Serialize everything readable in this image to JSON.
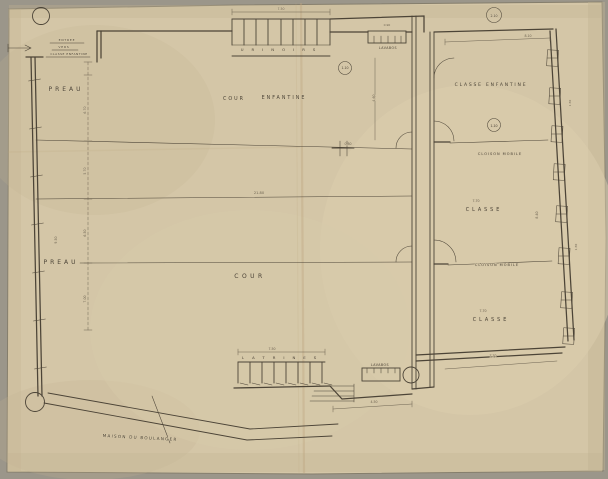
{
  "colors": {
    "margin": "#9b968a",
    "paper": "#d4c6a7",
    "paper_dark": "#c2b291",
    "edge": "#857e6c",
    "crease": "#bfa57f",
    "ink": "#4c4437",
    "ink_light": "#6e6452"
  },
  "plan": {
    "labels": [
      {
        "id": "room-label-preau-upper",
        "text": "PREAU",
        "x": 66,
        "y": 91,
        "size": 6,
        "ls": 3
      },
      {
        "id": "room-label-preau-lower",
        "text": "PREAU",
        "x": 61,
        "y": 264,
        "size": 6,
        "ls": 3
      },
      {
        "id": "room-label-cour-word",
        "text": "COUR",
        "x": 234,
        "y": 100,
        "size": 4.8,
        "ls": 2
      },
      {
        "id": "room-label-enfantine-word",
        "text": "ENFANTINE",
        "x": 284,
        "y": 99,
        "size": 4.8,
        "ls": 2
      },
      {
        "id": "room-label-cour",
        "text": "COUR",
        "x": 250,
        "y": 278,
        "size": 6,
        "ls": 3.5
      },
      {
        "id": "room-label-classe-enfantine",
        "text": "CLASSE ENFANTINE",
        "x": 491,
        "y": 86,
        "size": 4.5,
        "ls": 1.8
      },
      {
        "id": "label-cloison-mobile-upper",
        "text": "CLOISON MOBILE",
        "x": 500,
        "y": 155,
        "size": 3.5,
        "ls": 1
      },
      {
        "id": "room-label-classe-middle",
        "text": "CLASSE",
        "x": 484,
        "y": 211,
        "size": 4.8,
        "ls": 3
      },
      {
        "id": "label-cloison-mobile-lower",
        "text": "CLOISON MOBILE",
        "x": 497,
        "y": 266,
        "size": 3.5,
        "ls": 1
      },
      {
        "id": "room-label-classe-lower",
        "text": "CLASSE",
        "x": 491,
        "y": 321,
        "size": 4.8,
        "ls": 3
      },
      {
        "id": "label-maison-du-boulanger",
        "text": "MAISON DU BOULANGER",
        "x": 140,
        "y": 439,
        "size": 4.2,
        "ls": 1.2,
        "rot": 3
      },
      {
        "id": "label-lavabos-upper",
        "text": "LAVABOS",
        "x": 388,
        "y": 49,
        "size": 3.2,
        "ls": 0.5
      },
      {
        "id": "label-lavabos-lower",
        "text": "LAVABOS",
        "x": 380,
        "y": 366,
        "size": 3.2,
        "ls": 0.5
      },
      {
        "id": "label-urinoirs",
        "text": "URINOIRS",
        "x": 282,
        "y": 51,
        "size": 3.8,
        "ls": 8
      },
      {
        "id": "label-latrines",
        "text": "LATRINES",
        "x": 283,
        "y": 359,
        "size": 3.8,
        "ls": 8
      },
      {
        "id": "note-entree",
        "text": "ENTREE",
        "x": 67,
        "y": 41,
        "size": 3,
        "ls": 0.8
      },
      {
        "id": "note-vers",
        "text": "VERS",
        "x": 64,
        "y": 48,
        "size": 3,
        "ls": 0.8
      },
      {
        "id": "note-classe-enfantine",
        "text": "CLASSE ENFANTINE",
        "x": 69,
        "y": 55,
        "size": 3,
        "ls": 0.5
      },
      {
        "id": "detail-bubble-top-right",
        "text": "2.10",
        "x": 494,
        "y": 17,
        "size": 3.2
      },
      {
        "id": "detail-bubble-stalls",
        "text": "1.10",
        "x": 345,
        "y": 69,
        "size": 3.2
      },
      {
        "id": "detail-bubble-right",
        "text": "1.10",
        "x": 494,
        "y": 127,
        "size": 3.2
      },
      {
        "id": "dim-total-width",
        "text": "21.80",
        "x": 259,
        "y": 194,
        "size": 3.6,
        "cls": "dim"
      },
      {
        "id": "dim-opening",
        "text": "0.80",
        "x": 348,
        "y": 145,
        "size": 3.2,
        "cls": "dim"
      },
      {
        "id": "dim-urinoirs",
        "text": "7.50",
        "x": 281,
        "y": 10,
        "size": 3.2,
        "cls": "dim"
      },
      {
        "id": "dim-latrines",
        "text": "7.50",
        "x": 272,
        "y": 350,
        "size": 3.2,
        "cls": "dim"
      },
      {
        "id": "dim-top-right",
        "text": "8.10",
        "x": 528,
        "y": 37,
        "size": 3.2,
        "cls": "dim"
      },
      {
        "id": "dim-classe-middle",
        "text": "7.70",
        "x": 476,
        "y": 202,
        "size": 3.2,
        "cls": "dim"
      },
      {
        "id": "dim-classe-lower",
        "text": "7.70",
        "x": 483,
        "y": 312,
        "size": 3.2,
        "cls": "dim"
      },
      {
        "id": "dim-bottom-right",
        "text": "7.70",
        "x": 493,
        "y": 357,
        "size": 3.2,
        "cls": "dim"
      },
      {
        "id": "dim-bottom-court",
        "text": "4.50",
        "x": 374,
        "y": 403,
        "size": 3.2,
        "cls": "dim"
      },
      {
        "id": "dim-lavabos",
        "text": "0.90",
        "x": 387,
        "y": 26,
        "size": 3,
        "cls": "dim"
      },
      {
        "id": "dim-preau-left",
        "text": "9.50",
        "x": 57,
        "y": 240,
        "size": 3.2,
        "rot": -90,
        "cls": "dim"
      },
      {
        "id": "dim-left-1",
        "text": "6.70",
        "x": 86,
        "y": 110,
        "size": 3.2,
        "rot": -90,
        "cls": "dim"
      },
      {
        "id": "dim-left-2",
        "text": "5.70",
        "x": 86,
        "y": 171,
        "size": 3.2,
        "rot": -90,
        "cls": "dim"
      },
      {
        "id": "dim-left-3",
        "text": "6.50",
        "x": 86,
        "y": 233,
        "size": 3.2,
        "rot": -90,
        "cls": "dim"
      },
      {
        "id": "dim-left-4",
        "text": "7.00",
        "x": 86,
        "y": 299,
        "size": 3.2,
        "rot": -90,
        "cls": "dim"
      },
      {
        "id": "dim-court-vert",
        "text": "4.60",
        "x": 375,
        "y": 98,
        "size": 3.2,
        "rot": -90,
        "cls": "dim"
      },
      {
        "id": "dim-classe-depth",
        "text": "8.40",
        "x": 538,
        "y": 215,
        "size": 3.2,
        "rot": -90,
        "cls": "dim"
      },
      {
        "id": "dim-window-1",
        "text": "1.50",
        "x": 571,
        "y": 103,
        "size": 3,
        "rot": -90,
        "cls": "dim"
      },
      {
        "id": "dim-window-2",
        "text": "1.50",
        "x": 577,
        "y": 247,
        "size": 3,
        "rot": -90,
        "cls": "dim"
      }
    ]
  }
}
